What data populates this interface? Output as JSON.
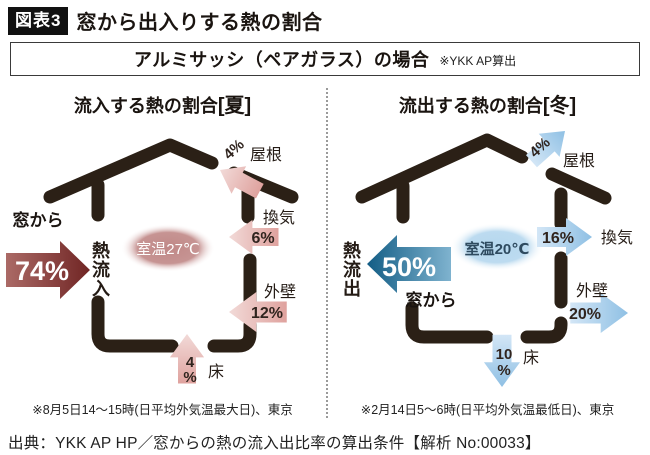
{
  "header": {
    "badge": "図表3",
    "title": "窓から出入りする熱の割合"
  },
  "subtitle": {
    "main": "アルミサッシ（ペアガラス）の場合",
    "note": "※YKK AP算出"
  },
  "panels": {
    "summer": {
      "title": "流入する熱の割合",
      "season": "[夏]",
      "window_label": "窓から",
      "window_value": "74%",
      "flow_chars": [
        "熱",
        "流",
        "入"
      ],
      "room_temp": "室温27℃",
      "roof_value": "4%",
      "roof_label": "屋根",
      "vent_label": "換気",
      "vent_value": "6%",
      "wall_label": "外壁",
      "wall_value": "12%",
      "floor_value_num": "4",
      "floor_value_pct": "%",
      "floor_label": "床",
      "note": "※8月5日14～15時(日平均外気温最大日)、東京"
    },
    "winter": {
      "title": "流出する熱の割合",
      "season": "[冬]",
      "window_label": "窓から",
      "window_value": "50%",
      "flow_chars": [
        "熱",
        "流",
        "出"
      ],
      "room_temp": "室温20℃",
      "roof_value": "4%",
      "roof_label": "屋根",
      "vent_label": "換気",
      "vent_value": "16%",
      "wall_label": "外壁",
      "wall_value": "20%",
      "floor_value_num": "10",
      "floor_value_pct": "%",
      "floor_label": "床",
      "note": "※2月14日5～6時(日平均外気温最低日)、東京"
    }
  },
  "source": "出典：YKK AP HP／窓からの熱の流入出比率の算出条件【解析 No:00033】",
  "colors": {
    "house": "#2b2016",
    "summer_big_tail": "#ab6a66",
    "summer_big_tip": "#702524",
    "summer_small_tail": "#dfa29e",
    "summer_small_tip": "#f2dad8",
    "summer_room": "#c08887",
    "winter_big_tail": "#7fb3cf",
    "winter_big_tip": "#135d85",
    "winter_small_tail": "#d3e6f6",
    "winter_small_tip": "#8fc0e4",
    "winter_room": "#b5d7ee"
  }
}
